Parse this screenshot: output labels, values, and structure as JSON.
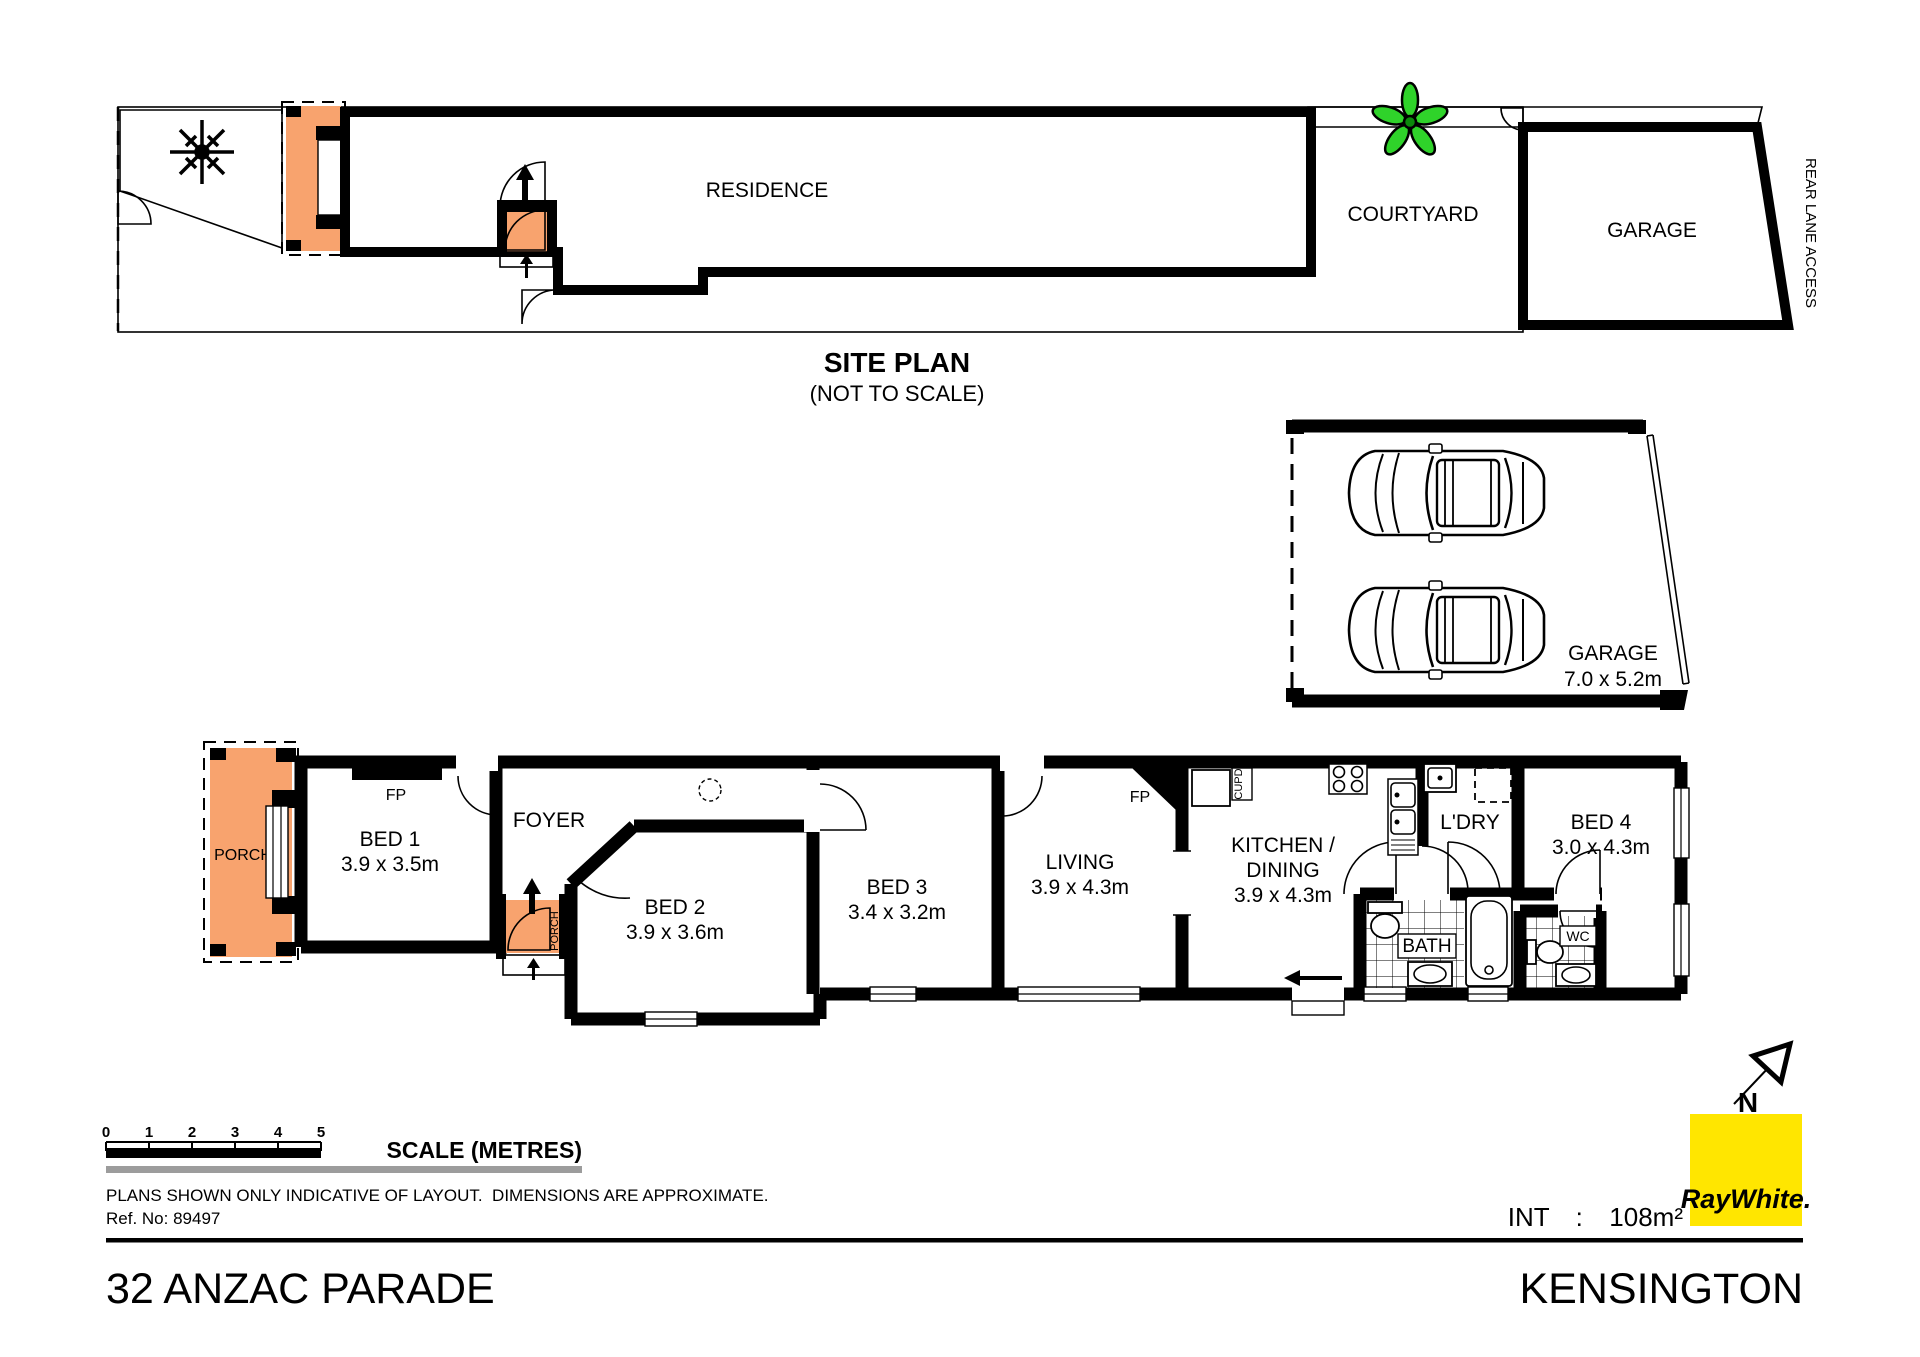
{
  "site_plan": {
    "title": "SITE PLAN",
    "subtitle": "(NOT TO SCALE)",
    "residence": "RESIDENCE",
    "courtyard": "COURTYARD",
    "garage": "GARAGE",
    "rear_lane": "REAR LANE ACCESS"
  },
  "garage_plan": {
    "label": "GARAGE",
    "dims": "7.0 x 5.2m"
  },
  "rooms": {
    "porch": "PORCH",
    "entry_porch": "PORCH",
    "bed1": "BED 1",
    "bed1_dims": "3.9 x 3.5m",
    "fp1": "FP",
    "foyer": "FOYER",
    "bed2": "BED 2",
    "bed2_dims": "3.9 x 3.6m",
    "bed3": "BED 3",
    "bed3_dims": "3.4 x 3.2m",
    "living": "LIVING",
    "living_dims": "3.9 x 4.3m",
    "fp2": "FP",
    "kitchen_line1": "KITCHEN /",
    "kitchen_line2": "DINING",
    "kitchen_dims": "3.9 x 4.3m",
    "cupd": "CUPD",
    "ldry": "L'DRY",
    "bath": "BATH",
    "wc": "WC",
    "bed4": "BED 4",
    "bed4_dims": "3.0 x 4.3m"
  },
  "scale_bar": {
    "ticks": [
      "0",
      "1",
      "2",
      "3",
      "4",
      "5"
    ],
    "label": "SCALE (METRES)"
  },
  "notes": {
    "disclaimer": "PLANS SHOWN ONLY INDICATIVE OF LAYOUT.  DIMENSIONS ARE APPROXIMATE.",
    "reference": "Ref. No: 89497"
  },
  "footer": {
    "address": "32 ANZAC PARADE",
    "suburb": "KENSINGTON",
    "internal_area": "INT  :  108m²"
  },
  "branding": {
    "logo_text": "RayWhite.",
    "north_label": "N"
  },
  "colors": {
    "porch_orange": "#F8A36E",
    "step_pink": "#FBD9C2",
    "grass_green": "#8BC327",
    "plant_green": "#2FD32A",
    "lot_gray": "#DBDBDB",
    "scale_gray": "#9C9C9C",
    "logo_yellow": "#FFE600",
    "logo_gray": "#58595B"
  }
}
